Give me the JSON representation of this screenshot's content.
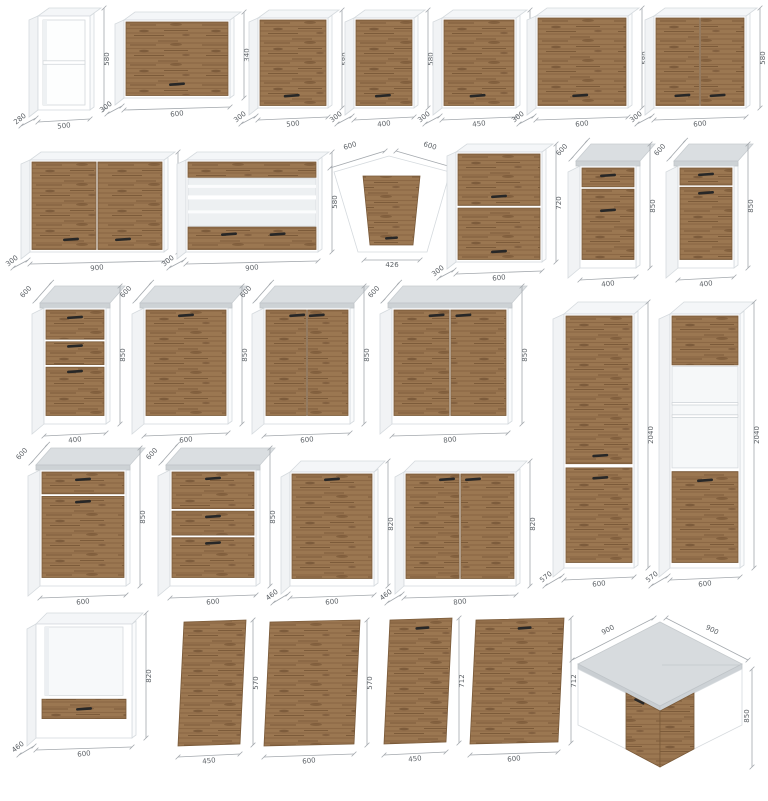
{
  "colors": {
    "wood": "#9b7751",
    "wood_edge": "#7a5a39",
    "carcass": "#ffffff",
    "countertop": "#d3d7da",
    "handle": "#272727",
    "dimension_lines": "#a3a8ad"
  },
  "rows": [
    {
      "items": [
        {
          "name": "wall-open-unit-500",
          "kind": "open wall unit",
          "width": "500",
          "depth": "280",
          "height": "580"
        },
        {
          "name": "wall-flap-cabinet-600",
          "kind": "flap-door wall cabinet",
          "width": "600",
          "depth": "300",
          "height": "340"
        },
        {
          "name": "wall-cabinet-1door-500",
          "kind": "wall cabinet 1 door",
          "width": "500",
          "depth": "300",
          "height": "580"
        },
        {
          "name": "wall-cabinet-1door-400",
          "kind": "wall cabinet 1 door",
          "width": "400",
          "depth": "300",
          "height": "580"
        },
        {
          "name": "wall-cabinet-1door-450",
          "kind": "wall cabinet 1 door",
          "width": "450",
          "depth": "300",
          "height": "580"
        },
        {
          "name": "wall-cabinet-1door-600",
          "kind": "wall cabinet 1 door",
          "width": "600",
          "depth": "300",
          "height": "580"
        },
        {
          "name": "wall-cabinet-2door-600",
          "kind": "wall cabinet 2 doors",
          "width": "600",
          "depth": "300",
          "height": "580"
        }
      ]
    },
    {
      "items": [
        {
          "name": "wall-cabinet-2door-900",
          "kind": "wall cabinet 2 doors",
          "width": "900",
          "depth": "300",
          "height": "580"
        },
        {
          "name": "wall-display-cabinet-900",
          "kind": "glass wall cabinet",
          "width": "900",
          "depth": "300",
          "height": "580"
        },
        {
          "name": "wall-corner-cabinet",
          "kind": "corner wall cabinet",
          "width_left": "600",
          "width_right": "600",
          "door_width": "426",
          "height": "580"
        },
        {
          "name": "wall-cabinet-2door-tall-600",
          "kind": "wall cabinet 2 stacked doors",
          "width": "600",
          "depth": "300",
          "height": "720"
        },
        {
          "name": "base-cabinet-drawer-door-400",
          "kind": "base cabinet drawer + door",
          "width": "400",
          "depth": "600",
          "height": "850"
        },
        {
          "name": "base-cabinet-drawer-door-400-b",
          "kind": "base cabinet drawer + door",
          "width": "400",
          "depth": "600",
          "height": "850"
        }
      ]
    },
    {
      "items": [
        {
          "name": "base-cabinet-3drawer-400",
          "kind": "base cabinet 3 drawers",
          "width": "400",
          "depth": "600",
          "height": "850"
        },
        {
          "name": "base-cabinet-1door-600",
          "kind": "base cabinet 1 door",
          "width": "600",
          "depth": "600",
          "height": "850"
        },
        {
          "name": "base-cabinet-2door-600",
          "kind": "base cabinet 2 doors",
          "width": "600",
          "depth": "600",
          "height": "850"
        },
        {
          "name": "base-cabinet-2door-800",
          "kind": "base cabinet 2 doors",
          "width": "800",
          "depth": "600",
          "height": "850"
        },
        {
          "name": "tall-cabinet-2door-600",
          "kind": "tall cabinet 2 doors",
          "width": "600",
          "depth": "570",
          "height": "2040"
        },
        {
          "name": "tall-oven-cabinet-600",
          "kind": "tall oven housing with niche",
          "width": "600",
          "depth": "570",
          "height": "2040"
        }
      ]
    },
    {
      "items": [
        {
          "name": "base-cabinet-drawer-door-600",
          "kind": "base cabinet drawer + door",
          "width": "600",
          "depth": "600",
          "height": "850"
        },
        {
          "name": "base-cabinet-3drawer-600",
          "kind": "base cabinet 3 drawers",
          "width": "600",
          "depth": "600",
          "height": "850"
        },
        {
          "name": "base-cabinet-1door-no-top-600",
          "kind": "base cabinet no worktop",
          "width": "600",
          "depth": "460",
          "height": "820"
        },
        {
          "name": "base-cabinet-2door-no-top-800",
          "kind": "base cabinet 2 doors no worktop",
          "width": "800",
          "depth": "460",
          "height": "820"
        }
      ]
    },
    {
      "items": [
        {
          "name": "oven-base-housing-600",
          "kind": "oven housing base unit",
          "width": "600",
          "depth": "460",
          "height": "820"
        },
        {
          "name": "front-panel-450x570",
          "kind": "front panel",
          "width": "450",
          "height": "570"
        },
        {
          "name": "front-panel-600x570",
          "kind": "front panel",
          "width": "600",
          "height": "570"
        },
        {
          "name": "appliance-door-450x712",
          "kind": "appliance front with handle",
          "width": "450",
          "height": "712"
        },
        {
          "name": "appliance-door-600x712",
          "kind": "appliance front with handle",
          "width": "600",
          "height": "712"
        },
        {
          "name": "corner-base-cabinet-900",
          "kind": "corner base cabinet",
          "width_left": "900",
          "width_right": "900",
          "height": "850"
        }
      ]
    }
  ]
}
